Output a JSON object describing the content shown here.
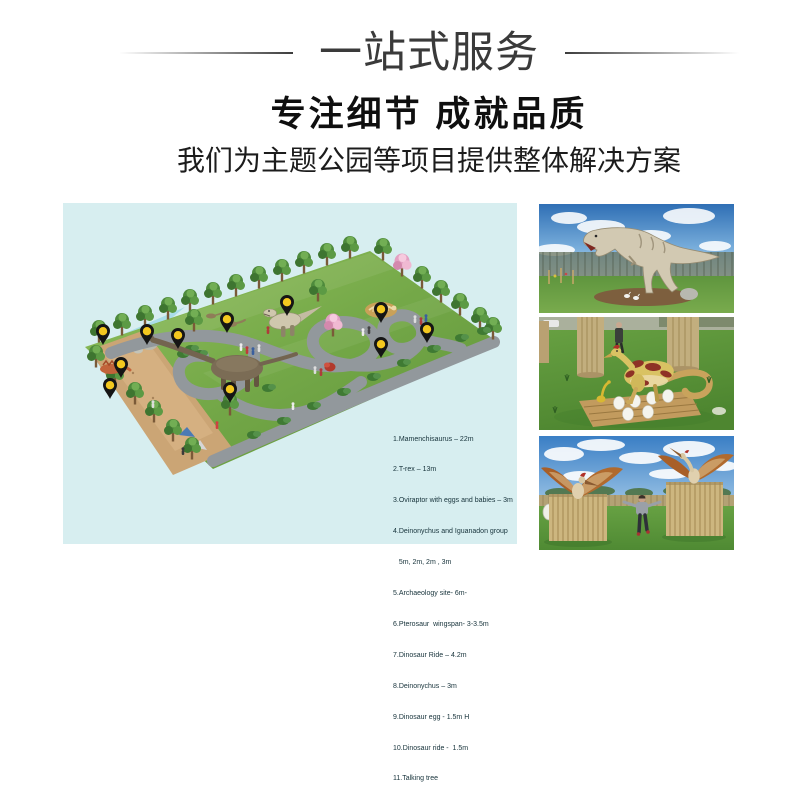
{
  "header": {
    "banner_title": "一站式服务",
    "headline": "专注细节 成就品质",
    "subheadline": "我们为主题公园等项目提供整体解决方案"
  },
  "map": {
    "pin_count": 11,
    "legend_lines": [
      "1.Mamenchisaurus – 22m",
      "2.T-rex – 13m",
      "3.Oviraptor with eggs and babies – 3m",
      "4.Deinonychus and Iguanadon group",
      "   5m, 2m, 2m , 3m",
      "5.Archaeology site- 6m-",
      "6.Pterosaur  wingspan- 3-3.5m",
      "7.Dinosaur Ride – 4.2m",
      "8.Deinonychus – 3m",
      "9.Dinosaur egg - 1.5m H",
      "10.Dinosaur ride -  1.5m",
      "11.Talking tree"
    ]
  },
  "colors": {
    "map_background": "#d7eef0",
    "pin_yellow": "#f4c81f",
    "title_text": "#3a3a3a",
    "headline_text": "#0f0f0f"
  }
}
